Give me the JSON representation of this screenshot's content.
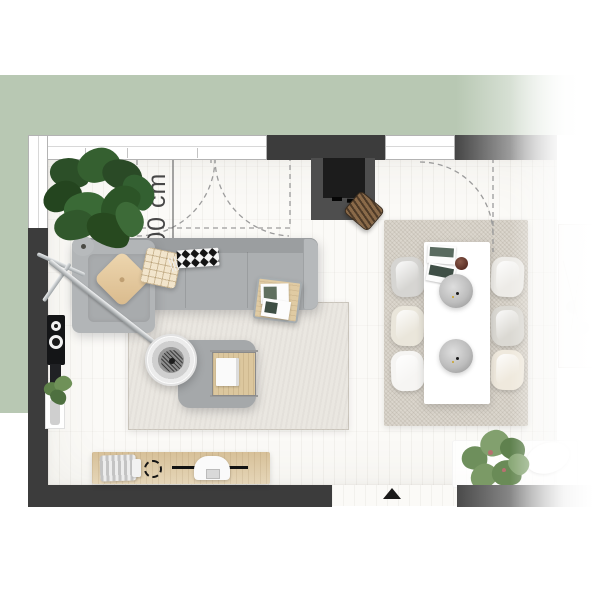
{
  "title": "Living room floor plan — top view",
  "annotations": {
    "clearance": "≥100 cm"
  },
  "palette": {
    "backdrop_green": "#b8c8b3",
    "wall_dark": "#3c3c3c",
    "floor": "#fbfaf7",
    "sofa_gray": "#acafb1",
    "wood_light": "#ddc8a0",
    "rug_living": "#eae7e1",
    "rug_dining": "#dbd6cd",
    "table_white": "#ffffff",
    "plant_dark": "#31582c",
    "plant_light": "#7d9c6b"
  },
  "furniture": {
    "sofa": "Corner sofa",
    "chaise": "Sofa chaise module",
    "pillow_plain": "Beige cushion",
    "pillow_check": "Checked cushion",
    "throw": "Black and white throw blanket",
    "side_table": "Side table with magazines",
    "floor_lamp": "Arc floor lamp",
    "ottoman": "Ottoman with wooden tray",
    "living_rug": "Living room rug",
    "dining_rug": "Dining area rug",
    "dining_table": "Dining table",
    "dining_chair": "Dining chair",
    "pendant": "Pendant lamp",
    "fireplace": "Fireplace",
    "log_basket": "Firewood basket",
    "media_console": "Media sideboard",
    "speaker": "Loudspeaker",
    "radiator": "Wall console",
    "plant_big": "Fiddle leaf fig plant",
    "plant_small": "Potted plant",
    "plant_floor": "Floor plant",
    "bench": "Low bench",
    "oval_dish": "Decor dish",
    "entrance": "Entrance marker",
    "clearance_zone": "Door clearance zone",
    "door_double": "Double door swing",
    "door_single": "Door swing",
    "window": "Window band"
  }
}
